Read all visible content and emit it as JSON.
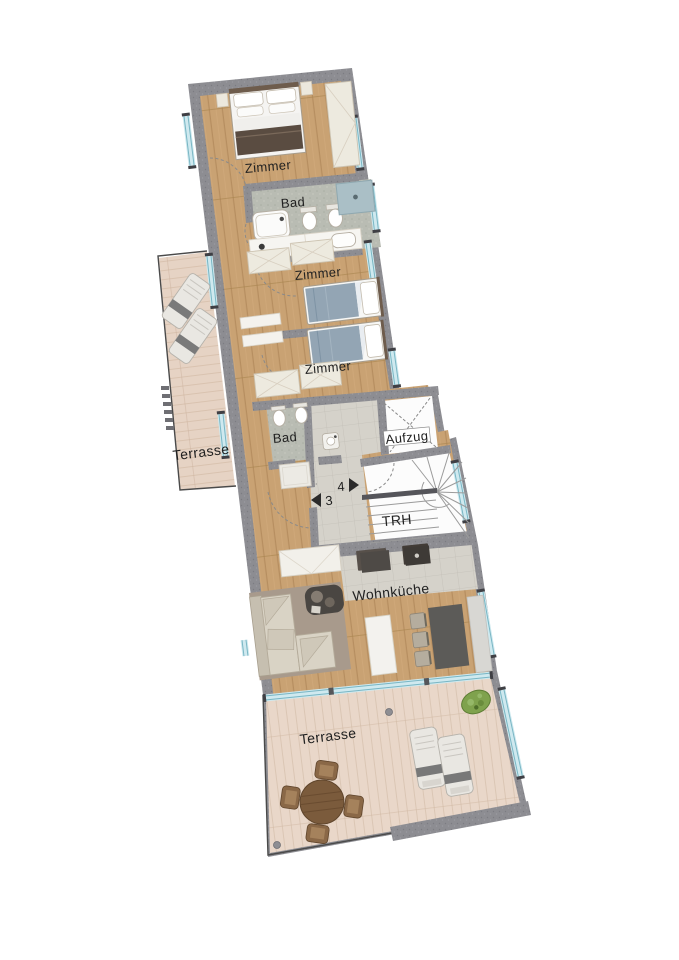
{
  "labels": {
    "bedroom1": "Zimmer",
    "bath1": "Bad",
    "bedroom2": "Zimmer",
    "bedroom3": "Zimmer",
    "bath2": "Bad",
    "elevator": "Aufzug",
    "stairwell": "TRH",
    "living": "Wohnküche",
    "terrace_left": "Terrasse",
    "terrace_bottom": "Terrasse",
    "unit4": "4",
    "unit3": "3"
  },
  "palette": {
    "wall": "#8d8d92",
    "wood_floor": "#c9a273",
    "terrace_floor": "#e8d6c8",
    "bath_floor": "#b9bcb3",
    "tile_floor": "#d5d2ca",
    "window_glass": "#cfe9ef",
    "stair_white": "#fcfcfc",
    "label_text": "#212121"
  }
}
